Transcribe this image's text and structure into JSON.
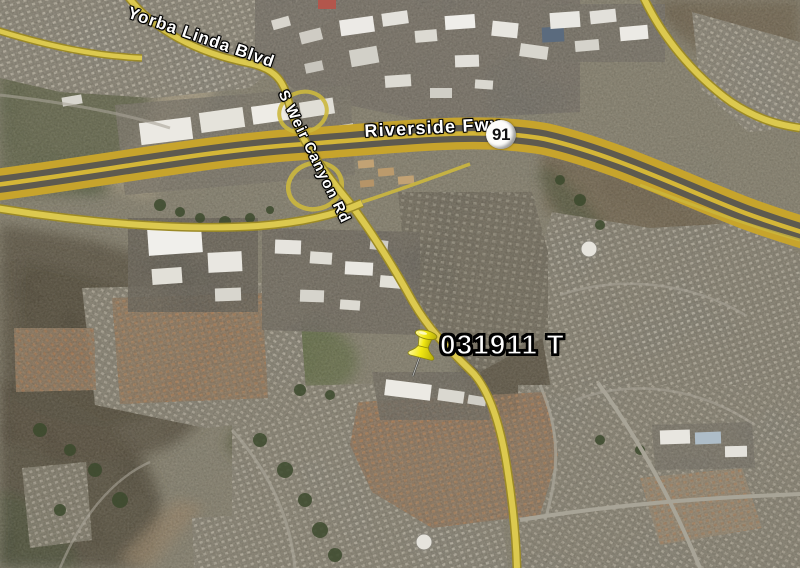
{
  "map": {
    "type": "satellite",
    "road_labels": [
      {
        "id": "yorba-linda-blvd",
        "text": "Yorba Linda Blvd"
      },
      {
        "id": "s-weir-canyon-rd",
        "text": "S Weir Canyon Rd"
      },
      {
        "id": "riverside-fwy",
        "text": "Riverside Fwy"
      }
    ],
    "highway_shield": {
      "number": "91"
    },
    "placemark": {
      "label": "031911 T",
      "icon": "yellow-pushpin"
    },
    "colors": {
      "road_yellow": "#dcc94f",
      "freeway_edge_yellow": "#c7a42c",
      "label_text": "#ffffff",
      "label_outline": "#000000",
      "pushpin_yellow": "#f0e816",
      "shield_background": "#fdfdfb",
      "shield_text": "#111111"
    }
  }
}
